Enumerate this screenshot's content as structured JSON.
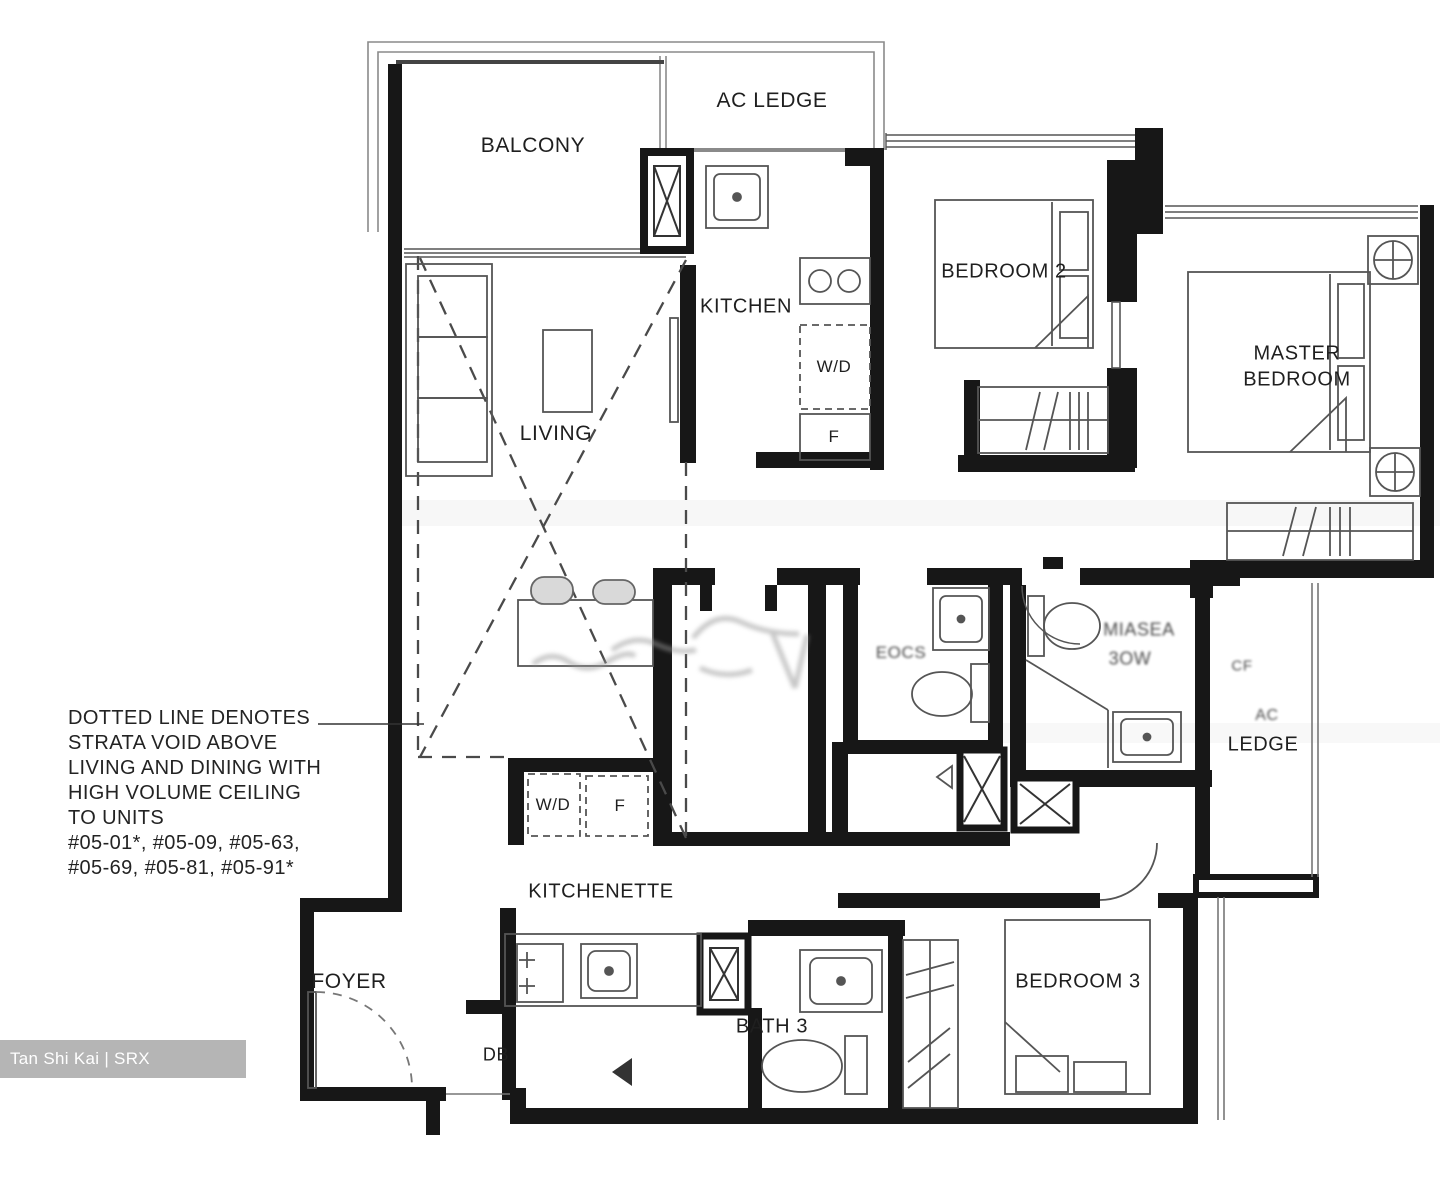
{
  "floor_plan": {
    "rooms": {
      "balcony": "BALCONY",
      "ac_ledge": "AC LEDGE",
      "kitchen": "KITCHEN",
      "bedroom_2": "BEDROOM 2",
      "master_bedroom_line1": "MASTER",
      "master_bedroom_line2": "BEDROOM",
      "living": "LIVING",
      "kitchenette": "KITCHENETTE",
      "foyer": "FOYER",
      "bath_3": "BATH 3",
      "bedroom_3": "BEDROOM 3",
      "ledge": "LEDGE"
    },
    "fixtures": {
      "washer_dryer_kitchen": "W/D",
      "fridge_kitchen": "F",
      "washer_dryer_kitchenette": "W/D",
      "fridge_kitchenette": "F",
      "distribution_board": "DB"
    },
    "garbled_labels": {
      "master_bath_line1": "MIASEA",
      "master_bath_line2": "3OW",
      "bath_2": "EOCS",
      "ledge_ac": "AC",
      "ledge_cf": "CF"
    },
    "note": {
      "lines": [
        "DOTTED LINE DENOTES",
        "STRATA VOID ABOVE",
        "LIVING AND DINING WITH",
        "HIGH VOLUME CEILING",
        "TO UNITS",
        "#05-01*, #05-09, #05-63,",
        "#05-69, #05-81, #05-91*"
      ]
    },
    "watermark": "Tan Shi Kai | SRX PROPERTY",
    "colors": {
      "wall": "#171717",
      "thin_line": "#8a8a8a",
      "furniture_line": "#555555",
      "watermark_bg": "#b5b5b5",
      "watermark_text": "#ffffff",
      "background": "#ffffff"
    }
  }
}
